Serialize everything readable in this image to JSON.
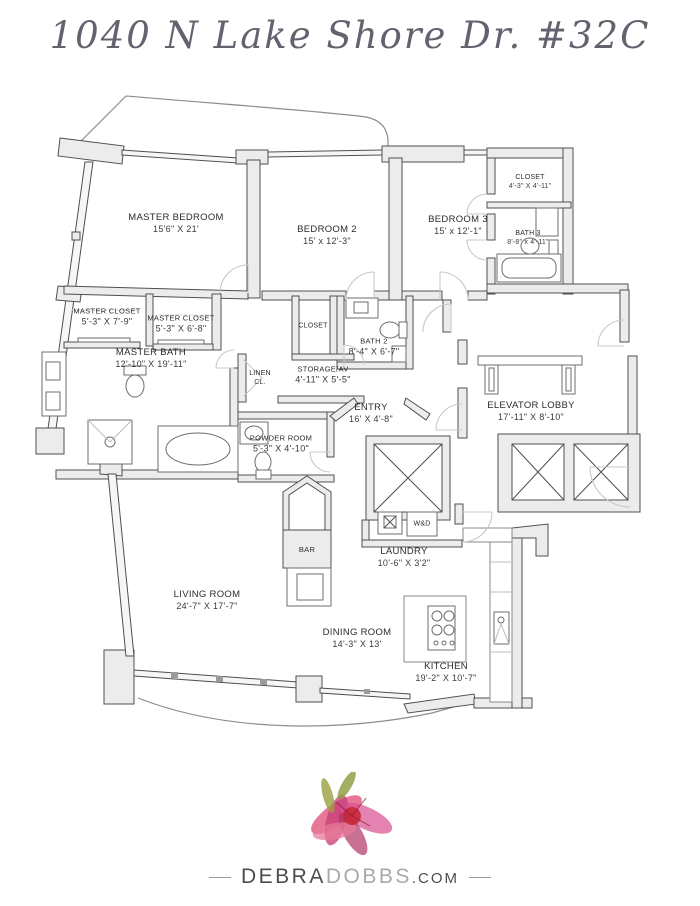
{
  "page": {
    "title": "1040 N Lake Shore Dr. #32C"
  },
  "rooms": {
    "master_bedroom": {
      "name": "MASTER BEDROOM",
      "dims": "15'6\" X 21'"
    },
    "bedroom_2": {
      "name": "BEDROOM 2",
      "dims": "15' x 12'-3\""
    },
    "bedroom_3": {
      "name": "BEDROOM 3",
      "dims": "15' x 12'-1\""
    },
    "closet_top": {
      "name": "CLOSET",
      "dims": "4'-3\" X 4'-11\""
    },
    "bath_3": {
      "name": "BATH 3",
      "dims": "8'-8\" x 4'-11\""
    },
    "master_closet_1": {
      "name": "MASTER CLOSET",
      "dims": "5'-3\" X 7'-9\""
    },
    "master_closet_2": {
      "name": "MASTER CLOSET",
      "dims": "5'-3\" X 6'-8\""
    },
    "master_bath": {
      "name": "MASTER BATH",
      "dims": "12'-10\" X 19'-11\""
    },
    "closet_center": {
      "name": "CLOSET"
    },
    "bath_2": {
      "name": "BATH 2",
      "dims": "8'-4\" X 6'-7\""
    },
    "storage_av": {
      "name": "STORAGE/AV",
      "dims": "4'-11\" X 5'-5\""
    },
    "linen": {
      "name": "LINEN",
      "dims": "CL."
    },
    "entry": {
      "name": "ENTRY",
      "dims": "16' X 4'-8\""
    },
    "elevator_lobby": {
      "name": "ELEVATOR LOBBY",
      "dims": "17'-11\" X 8'-10\""
    },
    "powder_room": {
      "name": "POWDER ROOM",
      "dims": "5'-3\" X 4'-10\""
    },
    "bar": {
      "name": "BAR"
    },
    "laundry": {
      "name": "LAUNDRY",
      "dims": "10'-6\" X 3'2\""
    },
    "living_room": {
      "name": "LIVING ROOM",
      "dims": "24'-7\" X 17'-7\""
    },
    "dining_room": {
      "name": "DINING ROOM",
      "dims": "14'-3\" X 13'"
    },
    "kitchen": {
      "name": "KITCHEN",
      "dims": "19'-2\" X 10'-7\""
    },
    "wd": {
      "name": "W&D"
    }
  },
  "logo": {
    "name_first": "DEBRA",
    "name_last": "DOBBS",
    "tld": ".com"
  },
  "colors": {
    "wall_fill": "#ececec",
    "wall_line": "#4f4f4f",
    "flower_accent": "#c62839",
    "title_text": "#63636f"
  }
}
